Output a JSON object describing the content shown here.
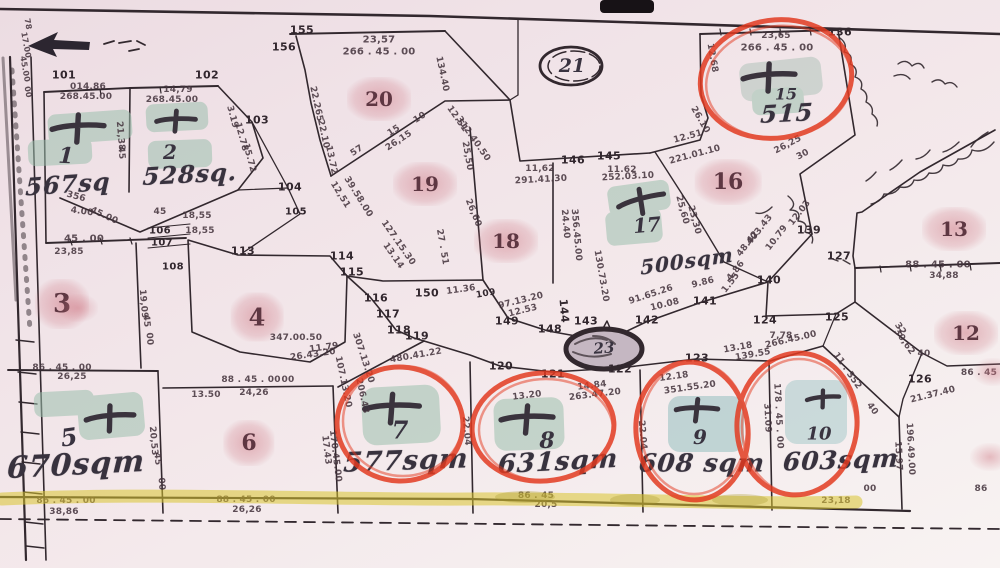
{
  "map": {
    "colors": {
      "paper": "#f2e6ea",
      "ink": "#32282e",
      "red_pen": "#e23a20",
      "green_highlight": "#9cc0ad",
      "teal_highlight": "#93bfc0",
      "yellow_highlight": "#d9c430",
      "pink_highlight": "#ce7682"
    },
    "annotations": {
      "red_circled_lots": [
        "7",
        "8",
        "9",
        "10",
        "15"
      ],
      "green_cross_lots": [
        "1",
        "2",
        "5",
        "7",
        "8",
        "9",
        "10",
        "15",
        "17"
      ],
      "pink_marked_lots": [
        "3",
        "4",
        "6",
        "12",
        "13",
        "16",
        "18",
        "19",
        "20"
      ],
      "circled_road_labels": [
        "21",
        "23"
      ]
    },
    "area_labels": [
      {
        "t": "567sq",
        "x": 68,
        "y": 184,
        "r": -4,
        "s": 24
      },
      {
        "t": "528sq.",
        "x": 190,
        "y": 174,
        "r": -3,
        "s": 24
      },
      {
        "t": "670sqm",
        "x": 76,
        "y": 465,
        "r": -3,
        "s": 30
      },
      {
        "t": "577sqm",
        "x": 406,
        "y": 461,
        "r": -2,
        "s": 27
      },
      {
        "t": "631sqm",
        "x": 558,
        "y": 462,
        "r": -3,
        "s": 26
      },
      {
        "t": "608 sqm",
        "x": 702,
        "y": 463,
        "r": 0,
        "s": 25
      },
      {
        "t": "603sqm",
        "x": 841,
        "y": 460,
        "r": -2,
        "s": 25
      },
      {
        "t": "515",
        "x": 787,
        "y": 113,
        "r": -3,
        "s": 24
      },
      {
        "t": "500sqm",
        "x": 687,
        "y": 261,
        "r": -8,
        "s": 20
      }
    ],
    "lot_labels_pencil": [
      {
        "t": "1",
        "x": 66,
        "y": 156,
        "r": 3,
        "s": 22
      },
      {
        "t": "2",
        "x": 170,
        "y": 152,
        "r": 0,
        "s": 20
      },
      {
        "t": "5",
        "x": 69,
        "y": 437,
        "r": -8,
        "s": 24
      },
      {
        "t": "7",
        "x": 400,
        "y": 430,
        "r": 0,
        "s": 24
      },
      {
        "t": "8",
        "x": 547,
        "y": 441,
        "r": 0,
        "s": 22
      },
      {
        "t": "9",
        "x": 700,
        "y": 437,
        "r": 0,
        "s": 20
      },
      {
        "t": "10",
        "x": 819,
        "y": 434,
        "r": 0,
        "s": 18
      },
      {
        "t": "15",
        "x": 786,
        "y": 94,
        "r": 0,
        "s": 16
      },
      {
        "t": "17",
        "x": 647,
        "y": 225,
        "r": -5,
        "s": 20
      },
      {
        "t": "21",
        "x": 572,
        "y": 66,
        "r": 0,
        "s": 19
      },
      {
        "t": "23",
        "x": 604,
        "y": 348,
        "r": -4,
        "s": 15
      }
    ],
    "lot_labels_pink": [
      {
        "t": "3",
        "x": 62,
        "y": 304,
        "s": 26
      },
      {
        "t": "4",
        "x": 257,
        "y": 317,
        "s": 24
      },
      {
        "t": "6",
        "x": 249,
        "y": 443,
        "s": 22
      },
      {
        "t": "12",
        "x": 966,
        "y": 333,
        "s": 20
      },
      {
        "t": "13",
        "x": 954,
        "y": 229,
        "s": 20
      },
      {
        "t": "16",
        "x": 728,
        "y": 182,
        "s": 22
      },
      {
        "t": "18",
        "x": 506,
        "y": 241,
        "s": 20
      },
      {
        "t": "19",
        "x": 425,
        "y": 184,
        "s": 20
      },
      {
        "t": "20",
        "x": 379,
        "y": 99,
        "s": 20
      }
    ],
    "point_labels": [
      {
        "t": "101",
        "x": 64,
        "y": 75
      },
      {
        "t": "102",
        "x": 207,
        "y": 75
      },
      {
        "t": "103",
        "x": 257,
        "y": 120
      },
      {
        "t": "104",
        "x": 290,
        "y": 187
      },
      {
        "t": "105",
        "x": 296,
        "y": 212,
        "s": 10
      },
      {
        "t": "106",
        "x": 160,
        "y": 231,
        "s": 10
      },
      {
        "t": "107",
        "x": 162,
        "y": 243,
        "s": 10
      },
      {
        "t": "108",
        "x": 173,
        "y": 267,
        "s": 10
      },
      {
        "t": "109",
        "x": 486,
        "y": 294,
        "r": -10,
        "s": 9
      },
      {
        "t": "113",
        "x": 243,
        "y": 251
      },
      {
        "t": "114",
        "x": 342,
        "y": 256
      },
      {
        "t": "115",
        "x": 352,
        "y": 272
      },
      {
        "t": "116",
        "x": 376,
        "y": 298
      },
      {
        "t": "117",
        "x": 388,
        "y": 314
      },
      {
        "t": "118",
        "x": 399,
        "y": 330
      },
      {
        "t": "119",
        "x": 417,
        "y": 336
      },
      {
        "t": "120",
        "x": 501,
        "y": 366
      },
      {
        "t": "121",
        "x": 553,
        "y": 374
      },
      {
        "t": "122",
        "x": 620,
        "y": 369
      },
      {
        "t": "123",
        "x": 697,
        "y": 358
      },
      {
        "t": "124",
        "x": 765,
        "y": 320
      },
      {
        "t": "125",
        "x": 837,
        "y": 317
      },
      {
        "t": "126",
        "x": 920,
        "y": 379
      },
      {
        "t": "127",
        "x": 839,
        "y": 256
      },
      {
        "t": "136",
        "x": 840,
        "y": 32
      },
      {
        "t": "139",
        "x": 809,
        "y": 230
      },
      {
        "t": "140",
        "x": 769,
        "y": 280
      },
      {
        "t": "141",
        "x": 705,
        "y": 301
      },
      {
        "t": "142",
        "x": 647,
        "y": 320
      },
      {
        "t": "143",
        "x": 586,
        "y": 321
      },
      {
        "t": "144",
        "x": 564,
        "y": 311,
        "r": 85
      },
      {
        "t": "145",
        "x": 609,
        "y": 156
      },
      {
        "t": "146",
        "x": 573,
        "y": 160
      },
      {
        "t": "148",
        "x": 550,
        "y": 329
      },
      {
        "t": "149",
        "x": 507,
        "y": 321
      },
      {
        "t": "150",
        "x": 427,
        "y": 293
      },
      {
        "t": "155",
        "x": 302,
        "y": 30
      },
      {
        "t": "156",
        "x": 284,
        "y": 47
      }
    ],
    "dimension_labels": [
      {
        "t": "014,86",
        "x": 88,
        "y": 87
      },
      {
        "t": "268.45.00",
        "x": 86,
        "y": 97
      },
      {
        "t": "14,79",
        "x": 178,
        "y": 90
      },
      {
        "t": "268.45.00",
        "x": 172,
        "y": 100
      },
      {
        "t": "21,38",
        "x": 120,
        "y": 136,
        "r": 85
      },
      {
        "t": "45",
        "x": 121,
        "y": 153,
        "r": 85
      },
      {
        "t": "3.19",
        "x": 232,
        "y": 117,
        "r": 75
      },
      {
        "t": "12.78",
        "x": 241,
        "y": 137,
        "r": 75
      },
      {
        "t": "15.72",
        "x": 249,
        "y": 158,
        "r": 75
      },
      {
        "t": "78",
        "x": 28,
        "y": 24,
        "r": 80,
        "s": 8
      },
      {
        "t": "17.00",
        "x": 26,
        "y": 45,
        "r": 80,
        "s": 8
      },
      {
        "t": "45.00",
        "x": 25,
        "y": 69,
        "r": 80,
        "s": 8
      },
      {
        "t": "00",
        "x": 28,
        "y": 92,
        "r": 80,
        "s": 8
      },
      {
        "t": "356",
        "x": 76,
        "y": 197,
        "r": 15
      },
      {
        "t": "4.00",
        "x": 82,
        "y": 212,
        "r": 8
      },
      {
        "t": "45.00",
        "x": 104,
        "y": 216,
        "r": 25
      },
      {
        "t": "45 . 00",
        "x": 84,
        "y": 239,
        "s": 10
      },
      {
        "t": "23,85",
        "x": 69,
        "y": 252
      },
      {
        "t": "45",
        "x": 160,
        "y": 212
      },
      {
        "t": "18,55",
        "x": 197,
        "y": 216
      },
      {
        "t": "18,55",
        "x": 200,
        "y": 231
      },
      {
        "t": "86 . 45 . 00",
        "x": 62,
        "y": 368
      },
      {
        "t": "26,25",
        "x": 72,
        "y": 377
      },
      {
        "t": "19,09",
        "x": 143,
        "y": 304,
        "r": 85
      },
      {
        "t": "45",
        "x": 146,
        "y": 321,
        "r": 85
      },
      {
        "t": "00",
        "x": 149,
        "y": 339,
        "r": 85
      },
      {
        "t": "347.00.50",
        "x": 296,
        "y": 338
      },
      {
        "t": "26.43.20",
        "x": 313,
        "y": 355,
        "r": -8
      },
      {
        "t": "11.79",
        "x": 324,
        "y": 348,
        "r": -8
      },
      {
        "t": "307.13.20",
        "x": 363,
        "y": 358,
        "r": 72
      },
      {
        "t": "480.41.22",
        "x": 416,
        "y": 356,
        "r": -10
      },
      {
        "t": "107.13.20",
        "x": 343,
        "y": 382,
        "r": 78
      },
      {
        "t": "206.43",
        "x": 362,
        "y": 396,
        "r": 78
      },
      {
        "t": "00",
        "x": 288,
        "y": 380
      },
      {
        "t": "88 . 45 . 00",
        "x": 251,
        "y": 380
      },
      {
        "t": "24,26",
        "x": 254,
        "y": 393
      },
      {
        "t": "13.50",
        "x": 206,
        "y": 395
      },
      {
        "t": "88 . 45 . 00",
        "x": 246,
        "y": 500
      },
      {
        "t": "26,26",
        "x": 247,
        "y": 510
      },
      {
        "t": "20,53",
        "x": 153,
        "y": 441,
        "r": 85
      },
      {
        "t": "45",
        "x": 157,
        "y": 459,
        "r": 85
      },
      {
        "t": "00",
        "x": 161,
        "y": 484,
        "r": 85
      },
      {
        "t": "86 . 45 . 00",
        "x": 66,
        "y": 501
      },
      {
        "t": "38,86",
        "x": 64,
        "y": 512
      },
      {
        "t": "170.45.00",
        "x": 335,
        "y": 456,
        "r": 83
      },
      {
        "t": "17.43",
        "x": 326,
        "y": 450,
        "r": 83
      },
      {
        "t": "22.04",
        "x": 466,
        "y": 431,
        "r": 85
      },
      {
        "t": "22.04",
        "x": 642,
        "y": 435,
        "r": 85
      },
      {
        "t": "13.20",
        "x": 527,
        "y": 396,
        "r": -7
      },
      {
        "t": "263.47.20",
        "x": 595,
        "y": 395,
        "r": -7
      },
      {
        "t": "14.84",
        "x": 592,
        "y": 386,
        "r": -7
      },
      {
        "t": "12.18",
        "x": 674,
        "y": 377,
        "r": -8
      },
      {
        "t": "351.55.20",
        "x": 690,
        "y": 388,
        "r": -8
      },
      {
        "t": "86 . 45",
        "x": 536,
        "y": 496
      },
      {
        "t": "20,5",
        "x": 546,
        "y": 505
      },
      {
        "t": "178 . 45 . 00",
        "x": 778,
        "y": 416,
        "r": 87
      },
      {
        "t": "31.09",
        "x": 767,
        "y": 418,
        "r": 87
      },
      {
        "t": "266.45.00",
        "x": 791,
        "y": 340,
        "r": -13
      },
      {
        "t": "13.18",
        "x": 738,
        "y": 348,
        "r": -10
      },
      {
        "t": "139.55",
        "x": 753,
        "y": 355,
        "r": -10
      },
      {
        "t": "11 . 352",
        "x": 847,
        "y": 371,
        "r": 55
      },
      {
        "t": "40",
        "x": 872,
        "y": 409,
        "r": 55
      },
      {
        "t": "7,78",
        "x": 781,
        "y": 336
      },
      {
        "t": "23,18",
        "x": 836,
        "y": 501
      },
      {
        "t": "00",
        "x": 870,
        "y": 489
      },
      {
        "t": "23,65",
        "x": 776,
        "y": 36
      },
      {
        "t": "266 . 45 . 00",
        "x": 777,
        "y": 48,
        "s": 10
      },
      {
        "t": "12.68",
        "x": 712,
        "y": 58,
        "r": 80
      },
      {
        "t": "26.10",
        "x": 700,
        "y": 120,
        "r": 60
      },
      {
        "t": "26,25",
        "x": 788,
        "y": 145,
        "r": -28
      },
      {
        "t": "30",
        "x": 803,
        "y": 155,
        "r": -28
      },
      {
        "t": "48.42",
        "x": 748,
        "y": 244,
        "r": -52
      },
      {
        "t": "403.43",
        "x": 760,
        "y": 230,
        "r": -52
      },
      {
        "t": "10.79",
        "x": 777,
        "y": 238,
        "r": -52
      },
      {
        "t": "12.03",
        "x": 800,
        "y": 213,
        "r": -52
      },
      {
        "t": "4.86",
        "x": 736,
        "y": 271,
        "r": -52
      },
      {
        "t": "1.55",
        "x": 731,
        "y": 283,
        "r": -52
      },
      {
        "t": "23,30",
        "x": 694,
        "y": 220,
        "r": 75
      },
      {
        "t": "25,60",
        "x": 682,
        "y": 210,
        "r": 75
      },
      {
        "t": "12.51",
        "x": 688,
        "y": 137,
        "r": -15
      },
      {
        "t": "221.01.10",
        "x": 695,
        "y": 155,
        "r": -15
      },
      {
        "t": "12.51",
        "x": 457,
        "y": 119,
        "r": 55
      },
      {
        "t": "312.40.50",
        "x": 473,
        "y": 139,
        "r": 55
      },
      {
        "t": "23,57",
        "x": 379,
        "y": 40,
        "s": 10
      },
      {
        "t": "266 . 45 . 00",
        "x": 379,
        "y": 52,
        "s": 10
      },
      {
        "t": "22.265",
        "x": 316,
        "y": 104,
        "r": 78
      },
      {
        "t": "22.10",
        "x": 323,
        "y": 134,
        "r": 78
      },
      {
        "t": "13.72",
        "x": 331,
        "y": 160,
        "r": 78
      },
      {
        "t": "57",
        "x": 357,
        "y": 151,
        "r": -33
      },
      {
        "t": "26,15",
        "x": 399,
        "y": 141,
        "r": -33
      },
      {
        "t": "15",
        "x": 394,
        "y": 131,
        "r": -33
      },
      {
        "t": "10",
        "x": 420,
        "y": 118,
        "r": -33
      },
      {
        "t": "134.40",
        "x": 442,
        "y": 74,
        "r": 78
      },
      {
        "t": "11,62",
        "x": 540,
        "y": 169
      },
      {
        "t": "291.41.30",
        "x": 541,
        "y": 180,
        "r": -3
      },
      {
        "t": "11.62",
        "x": 622,
        "y": 170
      },
      {
        "t": "252.03.10",
        "x": 628,
        "y": 177,
        "r": -3
      },
      {
        "t": "24.40",
        "x": 565,
        "y": 224,
        "r": 85
      },
      {
        "t": "356.45.00",
        "x": 576,
        "y": 235,
        "r": 85
      },
      {
        "t": "25,50",
        "x": 467,
        "y": 156,
        "r": 80
      },
      {
        "t": "26,60",
        "x": 473,
        "y": 213,
        "r": 68
      },
      {
        "t": "27 . 51",
        "x": 442,
        "y": 247,
        "r": 80
      },
      {
        "t": "39.58.00",
        "x": 358,
        "y": 197,
        "r": 58
      },
      {
        "t": "12,51",
        "x": 340,
        "y": 195,
        "r": 58
      },
      {
        "t": "127.15.30",
        "x": 398,
        "y": 243,
        "r": 55
      },
      {
        "t": "13.14",
        "x": 393,
        "y": 256,
        "r": 55
      },
      {
        "t": "11.36",
        "x": 461,
        "y": 290,
        "r": -8
      },
      {
        "t": "97.13.20",
        "x": 521,
        "y": 301,
        "r": -14
      },
      {
        "t": "12.53",
        "x": 523,
        "y": 311,
        "r": -14
      },
      {
        "t": "91.65.26",
        "x": 651,
        "y": 295,
        "r": -18
      },
      {
        "t": "9.86",
        "x": 703,
        "y": 283,
        "r": -14
      },
      {
        "t": "10.08",
        "x": 665,
        "y": 305,
        "r": -14
      },
      {
        "t": "130.73.20",
        "x": 601,
        "y": 276,
        "r": 80
      },
      {
        "t": "88 . 45 . 00",
        "x": 938,
        "y": 265,
        "s": 10
      },
      {
        "t": "34,88",
        "x": 944,
        "y": 276
      },
      {
        "t": "32",
        "x": 900,
        "y": 329,
        "r": 55
      },
      {
        "t": "30,62",
        "x": 904,
        "y": 342,
        "r": 55
      },
      {
        "t": "40",
        "x": 924,
        "y": 354
      },
      {
        "t": "86 . 45",
        "x": 979,
        "y": 373
      },
      {
        "t": "21.37.40",
        "x": 933,
        "y": 395,
        "r": -14
      },
      {
        "t": "196.49.00",
        "x": 910,
        "y": 449,
        "r": 87
      },
      {
        "t": "15.97",
        "x": 898,
        "y": 456,
        "r": 87
      },
      {
        "t": "86",
        "x": 981,
        "y": 489
      }
    ],
    "smudges": [
      {
        "t": "",
        "x": 993,
        "y": 372
      },
      {
        "t": "",
        "x": 990,
        "y": 457
      },
      {
        "t": "",
        "x": 78,
        "y": 308
      }
    ]
  }
}
